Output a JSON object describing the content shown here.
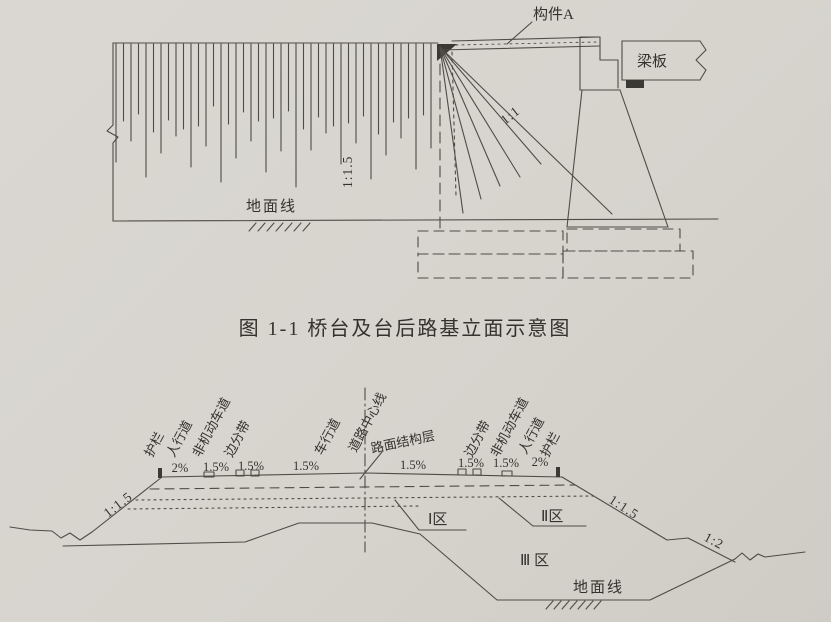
{
  "page": {
    "background": "#d8d5d0",
    "ink": "#4f4c46"
  },
  "figure1": {
    "caption": "图 1-1  桥台及台后路基立面示意图",
    "component_a": "构件A",
    "beam_slab": "梁板",
    "slope_front": "1:1",
    "slope_back": "1:1.5",
    "ground_line": "地面线"
  },
  "figure2": {
    "lanes_left": [
      "护栏",
      "人行道",
      "非机动车道",
      "边分带",
      "车行道",
      "道路中心线"
    ],
    "lanes_right": [
      "路面结构层",
      "边分带",
      "非机动车道",
      "人行道",
      "护栏"
    ],
    "grades_left": [
      "2%",
      "1.5%",
      "1.5%",
      "1.5%"
    ],
    "grades_right": [
      "1.5%",
      "1.5%",
      "1.5%",
      "2%"
    ],
    "zones": [
      "Ⅰ区",
      "Ⅱ区",
      "Ⅲ 区"
    ],
    "ground_line": "地面线",
    "slope_left": "1:1.5",
    "slope_right_upper": "1:1.5",
    "slope_right_lower": "1:2"
  }
}
